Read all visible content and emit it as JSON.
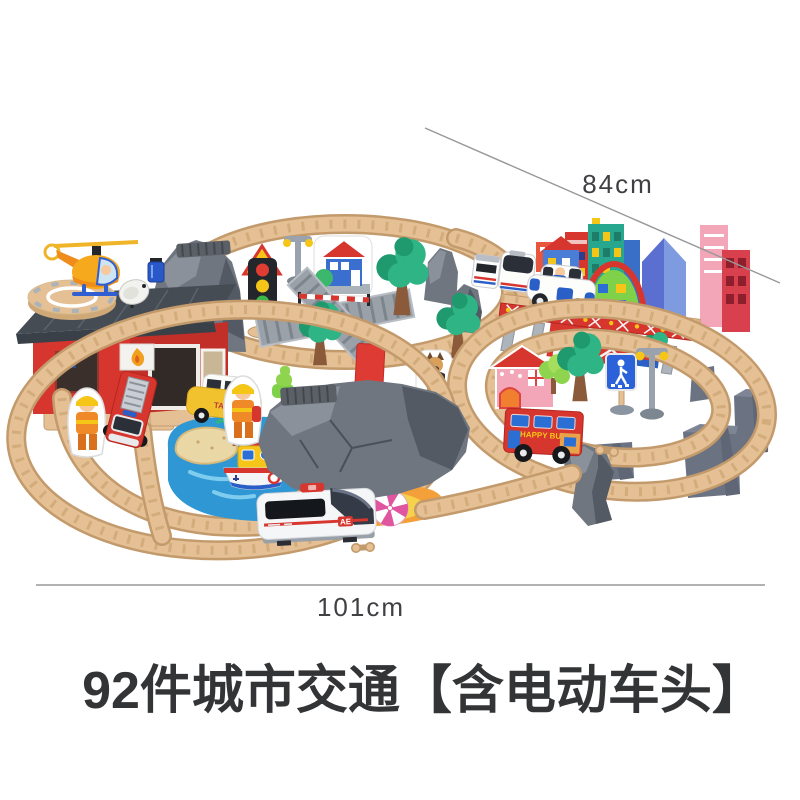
{
  "page": {
    "background": "#ffffff",
    "kind": "e-commerce product photo"
  },
  "dims": {
    "diagonal_label": "84cm",
    "width_label": "101cm"
  },
  "title": {
    "text": "92件城市交通【含电动车头】"
  },
  "scene": {
    "description": "wooden railway train set toy, figure-eight track city layout",
    "labels": {
      "taxi": "TAXI",
      "bus": "HAPPY BUS",
      "train_badge": "AE"
    },
    "items": [
      "helicopter",
      "helipad",
      "fire-station",
      "satellite-dish",
      "tunnel-rock",
      "traffic-light",
      "warning-triangle",
      "street-lamp",
      "house-cutout",
      "railroad-crossing",
      "crossing-barrier",
      "trees",
      "stop-sign",
      "dog-figure",
      "city-skyline",
      "green-dome-building",
      "red-bridge",
      "commuter-train",
      "police-car",
      "pink-house",
      "happy-bus",
      "pedestrian-sign",
      "track-risers",
      "rock-mountain",
      "water-mat",
      "sand-island",
      "palm-tree",
      "ferry-boat",
      "lighthouse",
      "beach",
      "beach-umbrella",
      "bullet-train",
      "taxi",
      "fire-truck",
      "firefighter-figures",
      "wooden-tracks"
    ]
  },
  "colors": {
    "white": "#ffffff",
    "text": "#3f4043",
    "line": "#97989a",
    "wood": "#e4c094",
    "wood_dark": "#c39a6b",
    "wood_line": "#d3ac7c",
    "rock": "#6f7680",
    "rock_light": "#8a919b",
    "rock_dark": "#545a64",
    "riser": "#6b7383",
    "water": "#2f97d4",
    "water_light": "#7ecdee",
    "sand": "#ead7a6",
    "beach_orange": "#f4a03a",
    "beach_yellow": "#f6d14a",
    "red": "#d6362e",
    "red_dark": "#b3261f",
    "roof": "#464c54",
    "green": "#2fb585",
    "green_dark": "#1f9a6e",
    "green_light": "#7fd14a",
    "trunk": "#8a5a3a",
    "yellow": "#f5c518",
    "orange": "#f08a28",
    "blue": "#2b5fc8",
    "blue_window": "#2b6fd4",
    "teal": "#27a88e",
    "pink": "#f2a6b8",
    "black": "#23272c",
    "gray_item": "#9aa3ad",
    "metal": "#b2b8c0"
  }
}
